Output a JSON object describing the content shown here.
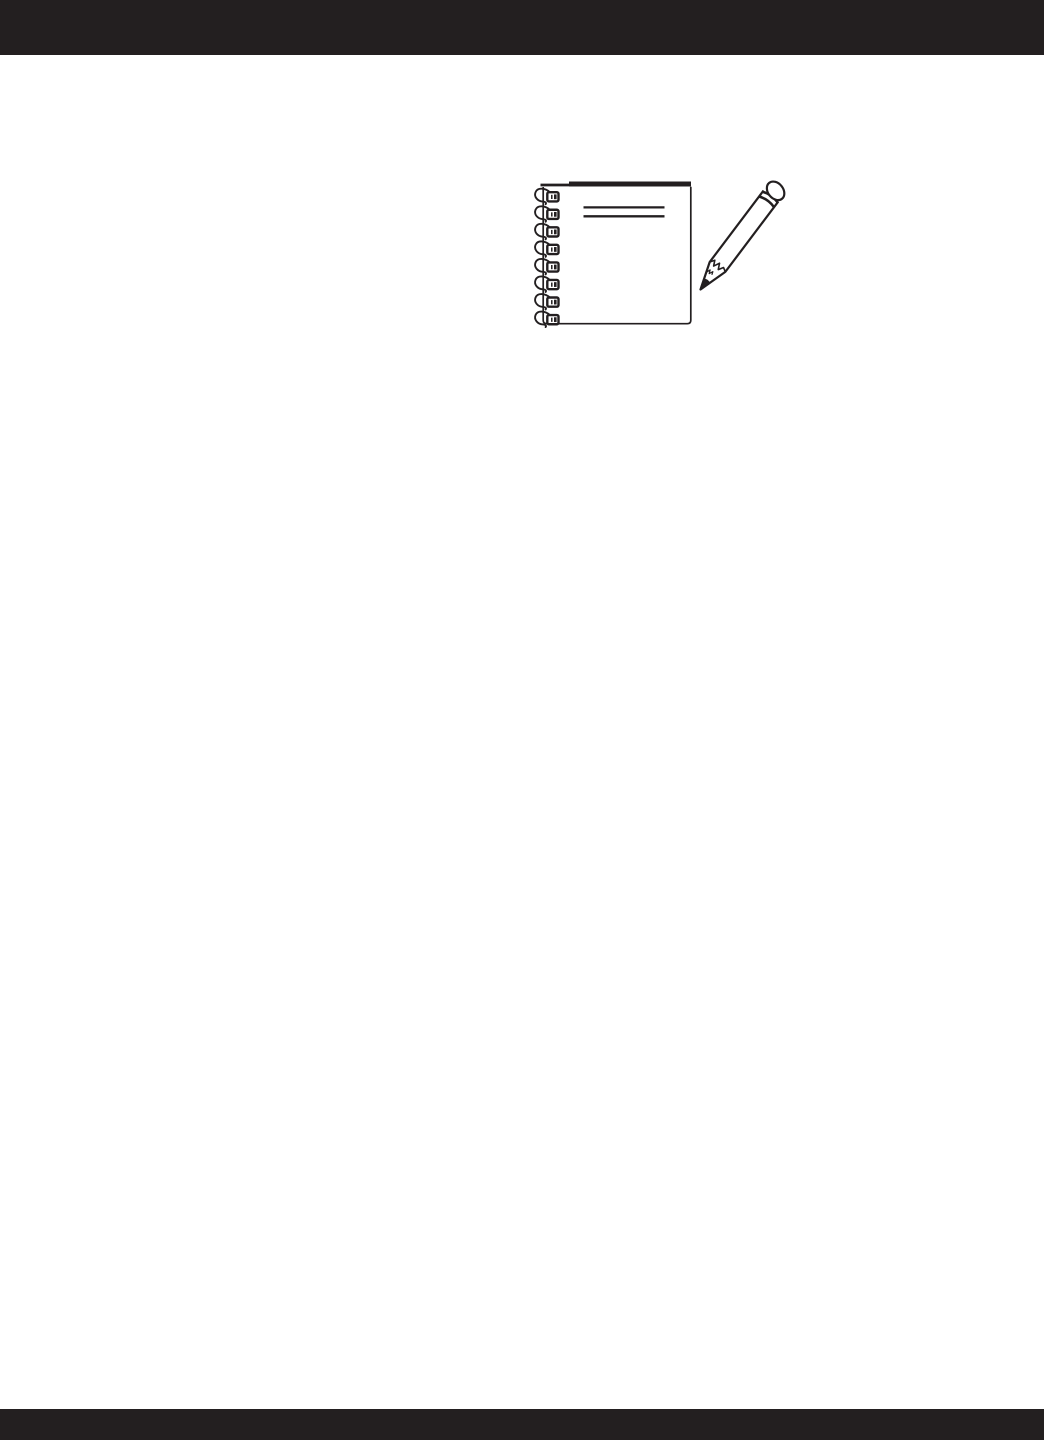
{
  "page": {
    "kind": "blank-notes-page",
    "visible_text": ""
  },
  "colors": {
    "bar": "#231f20",
    "ink": "#231f20",
    "paper": "#ffffff"
  },
  "header_bar": {
    "height_px": 55
  },
  "footer_bar": {
    "height_px": 31
  },
  "illustration": {
    "name": "spiral-notebook-with-pencil",
    "description": "black line drawing of a spiral-bound notebook with a sharpened pencil pointing at it",
    "spiral_ring_count": 8,
    "title_line_count": 2
  }
}
